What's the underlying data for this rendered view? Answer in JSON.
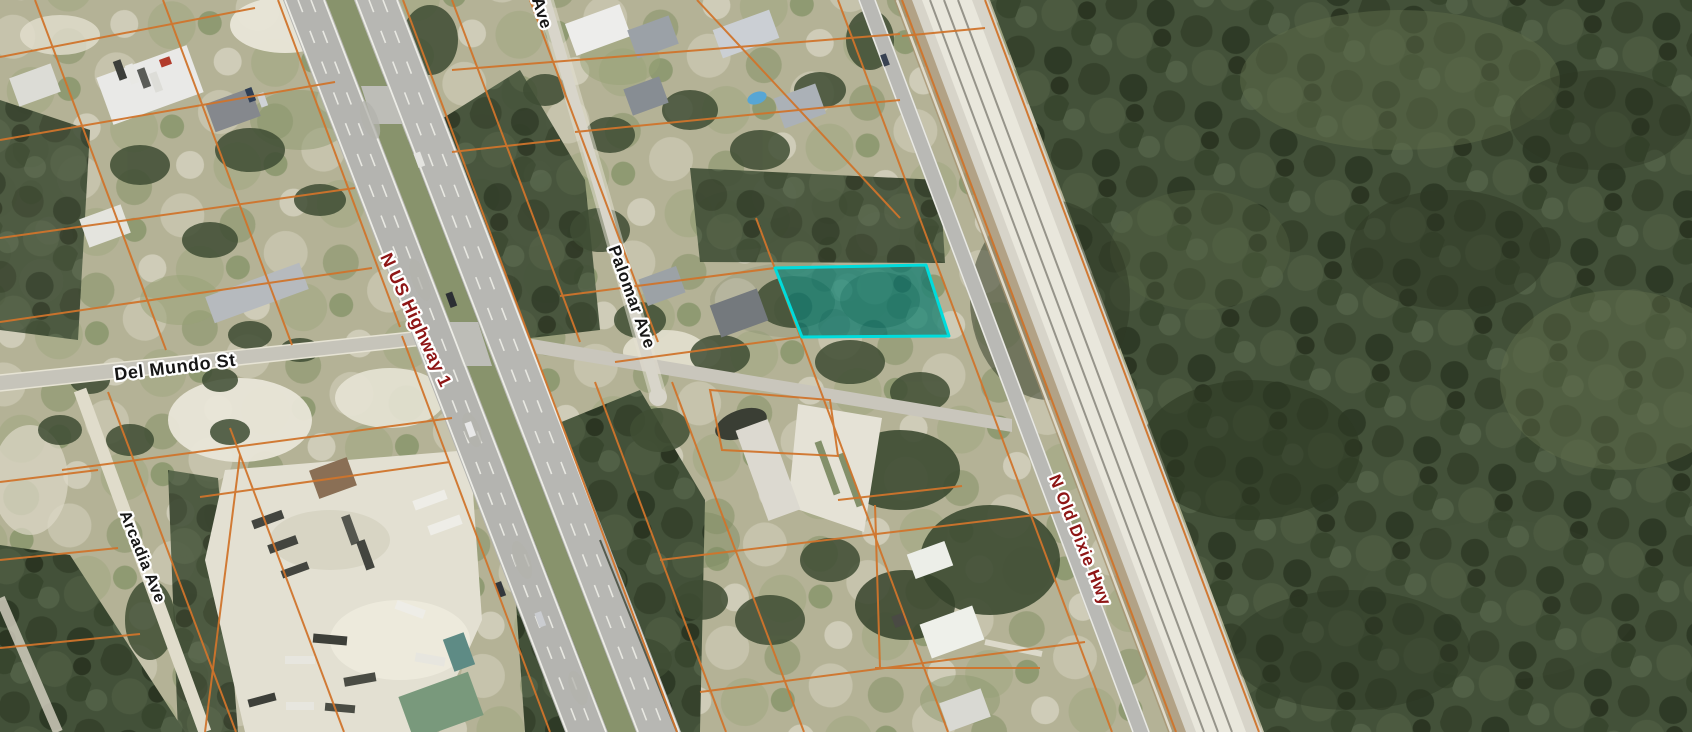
{
  "map": {
    "type": "aerial-parcel-map",
    "labels": {
      "partial_ave": "Ave",
      "palomar": "Palomar Ave",
      "del_mundo": "Del Mundo St",
      "us_highway": "N US Highway 1",
      "arcadia": "Arcadia Ave",
      "old_dixie": "N Old Dixie Hwy"
    },
    "selected_parcel": {
      "highlight_stroke": "#00dcdc",
      "highlight_fill": "rgba(0,220,220,0.33)"
    },
    "colors": {
      "parcel_line": "#d0742c",
      "street_label": "#161616",
      "highway_label": "#8e1515",
      "label_halo": "#ffffff"
    }
  }
}
